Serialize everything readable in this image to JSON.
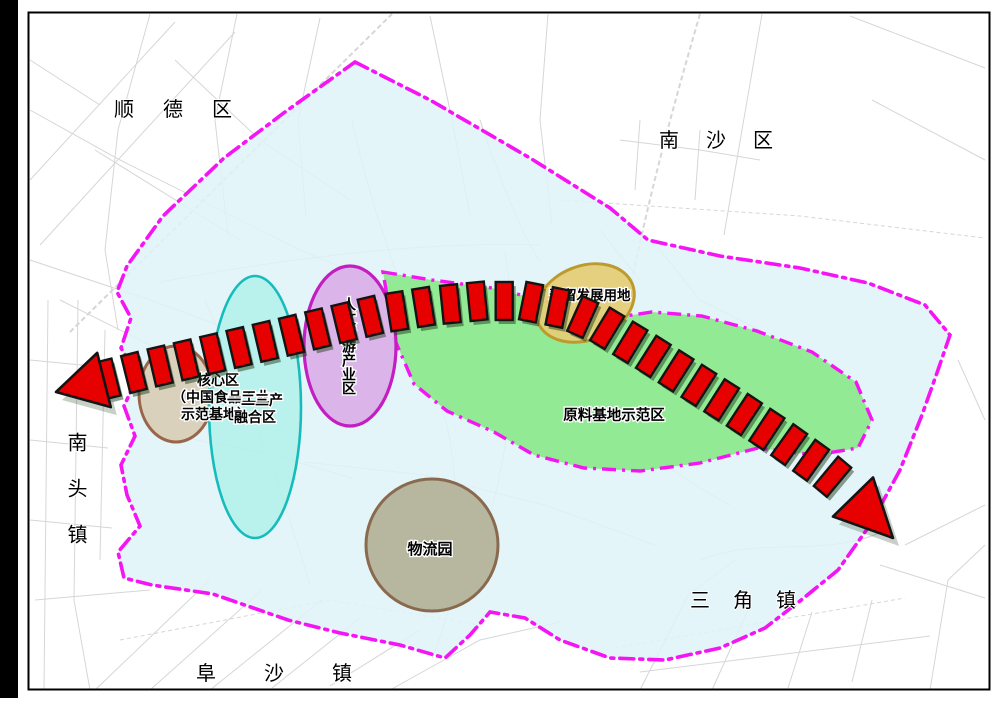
{
  "districts": {
    "shunde": "顺德区",
    "nansha": "南沙区",
    "nantou": "南头镇",
    "fusha": "阜沙镇",
    "sanjiao": "三角镇"
  },
  "zones": {
    "core_l1": "核心区",
    "core_l2": "（中国食品工业",
    "core_l3": "示范基地）",
    "integration_l1": "一二三产",
    "integration_l2": "融合区",
    "tourism": "人文旅游产业区",
    "reserved": "预留发展用地",
    "raw_material": "原料基地示范区",
    "logistics": "物流园"
  },
  "colors": {
    "boundary_magenta": "#F414F4",
    "planning_area_fill": "#DFF3F8",
    "raw_material_fill": "#8BE88B",
    "integration_fill": "#A8F0E8",
    "integration_stroke": "#16BCBC",
    "tourism_fill": "#D9AEE8",
    "tourism_stroke": "#C21EC2",
    "reserved_fill": "#E4CD77",
    "reserved_stroke": "#BC9A2E",
    "core_fill": "#D8CDB6",
    "core_stroke": "#99664A",
    "logistics_fill": "#B4B39B",
    "logistics_stroke": "#8A6A4E",
    "arrow_fill": "#E60000",
    "arrow_outline": "#141414",
    "road_grey": "#D6D6D6",
    "frame_black": "#000000"
  }
}
